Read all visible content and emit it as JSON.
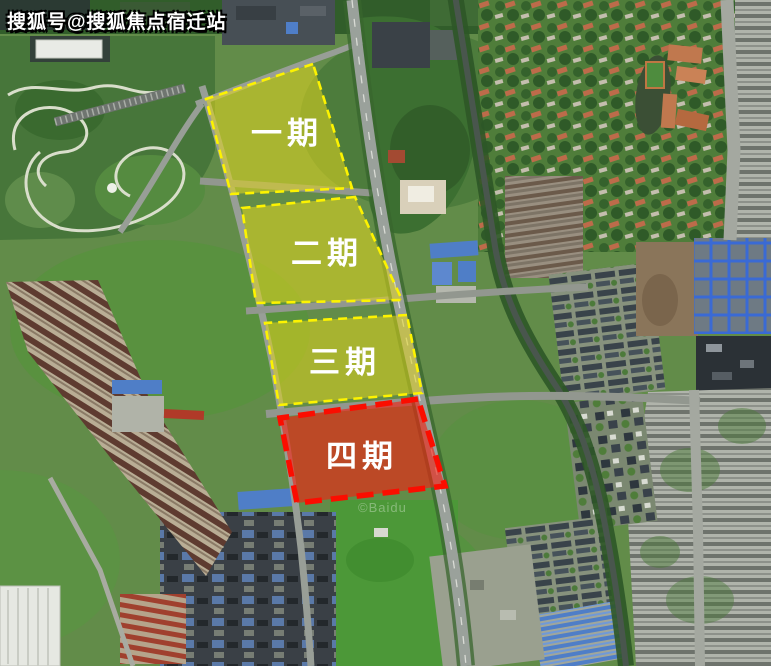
{
  "watermark": {
    "text": "搜狐号@搜狐焦点宿迁站"
  },
  "map_credit": {
    "text": "©Baidu"
  },
  "palette": {
    "phase_yellow_fill": "#e3d71d",
    "phase_yellow_border": "#fdf300",
    "phase_red_fill": "#f42012",
    "phase_red_border": "#fb0d00",
    "label_text": "#ffffff"
  },
  "phases": [
    {
      "label": "一期",
      "fill": "#e3d71d",
      "stroke": "#fdf300",
      "text_color": "#ffffff"
    },
    {
      "label": "二期",
      "fill": "#e3d71d",
      "stroke": "#fdf300",
      "text_color": "#ffffff"
    },
    {
      "label": "三期",
      "fill": "#e0d41c",
      "stroke": "#fdf300",
      "text_color": "#ffffff"
    },
    {
      "label": "四期",
      "fill": "#f42012",
      "stroke": "#fb0d00",
      "text_color": "#ffffff"
    }
  ]
}
